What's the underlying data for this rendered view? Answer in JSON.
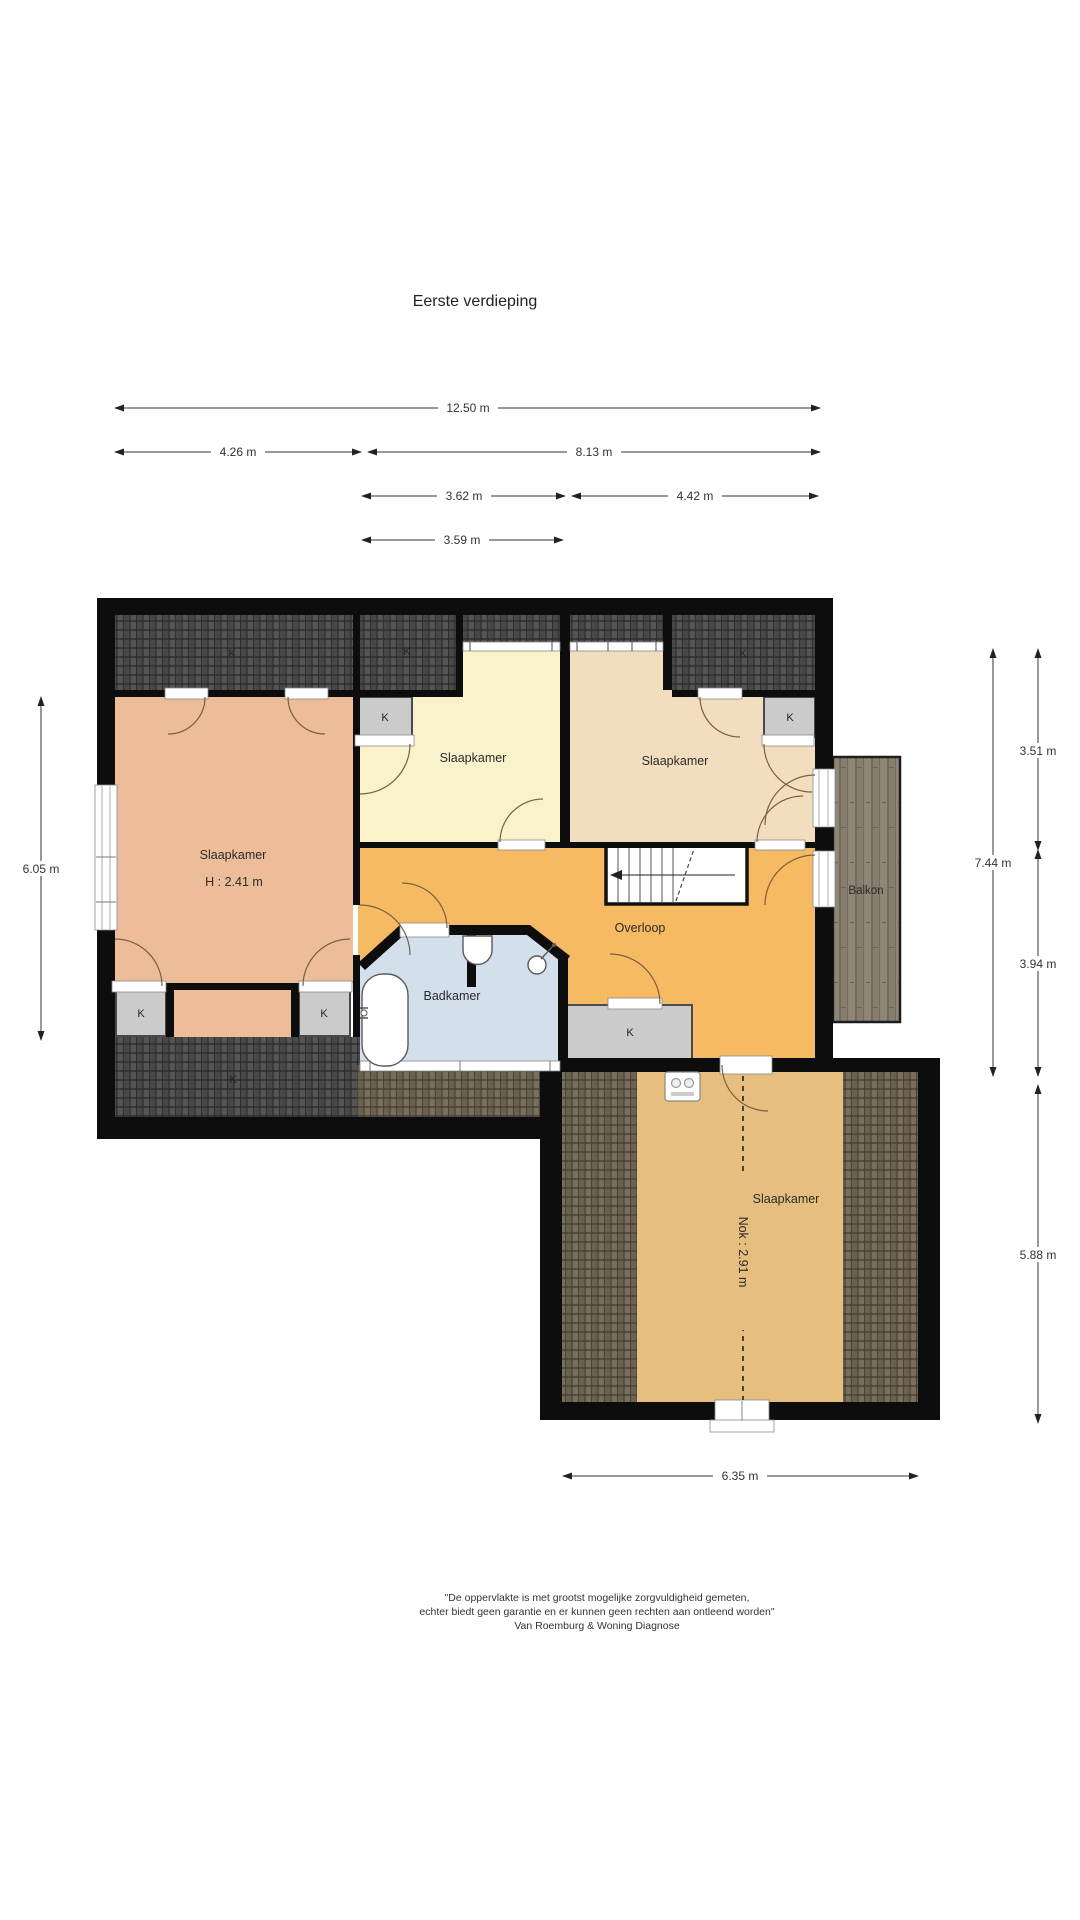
{
  "page": {
    "title": "Eerste verdieping"
  },
  "floorplan": {
    "closet_label": "K",
    "rooms": {
      "slaapkamer_left": {
        "name": "Slaapkamer",
        "height": "H : 2.41 m"
      },
      "slaapkamer_mid": {
        "name": "Slaapkamer"
      },
      "slaapkamer_right": {
        "name": "Slaapkamer"
      },
      "slaapkamer_bottom": {
        "name": "Slaapkamer",
        "ridge": "Nok : 2.91 m"
      },
      "overloop": {
        "name": "Overloop"
      },
      "badkamer": {
        "name": "Badkamer"
      },
      "balkon": {
        "name": "Balkon"
      }
    },
    "dimensions": {
      "top_total": "12.50 m",
      "top_left": "4.26 m",
      "top_right": "8.13 m",
      "mid_left": "3.62 m",
      "mid_right": "4.42 m",
      "mid_small": "3.59 m",
      "left_side": "6.05 m",
      "right_total": "7.44 m",
      "right_upper": "3.51 m",
      "right_lower": "3.94 m",
      "right_bottom": "5.88 m",
      "bottom": "6.35 m"
    },
    "colors": {
      "room_salmon": "#ecbd98",
      "room_yellow": "#f9f2cb",
      "room_peach": "#f3ddbf",
      "room_orange": "#f5ba62",
      "room_tan": "#e6bf7e",
      "room_blue": "#d3e0ec",
      "closet_gray": "#cbcbcb",
      "roof_dark": "#464646",
      "roof_brown": "#6f6757",
      "deck_wood": "#877e6f",
      "wall": "#0d0d0d"
    }
  },
  "footer": {
    "line1": "\"De oppervlakte is met grootst mogelijke zorgvuldigheid gemeten,",
    "line2": "echter biedt geen garantie en er kunnen geen rechten aan ontleend worden\"",
    "line3": "Van Roemburg & Woning Diagnose"
  }
}
